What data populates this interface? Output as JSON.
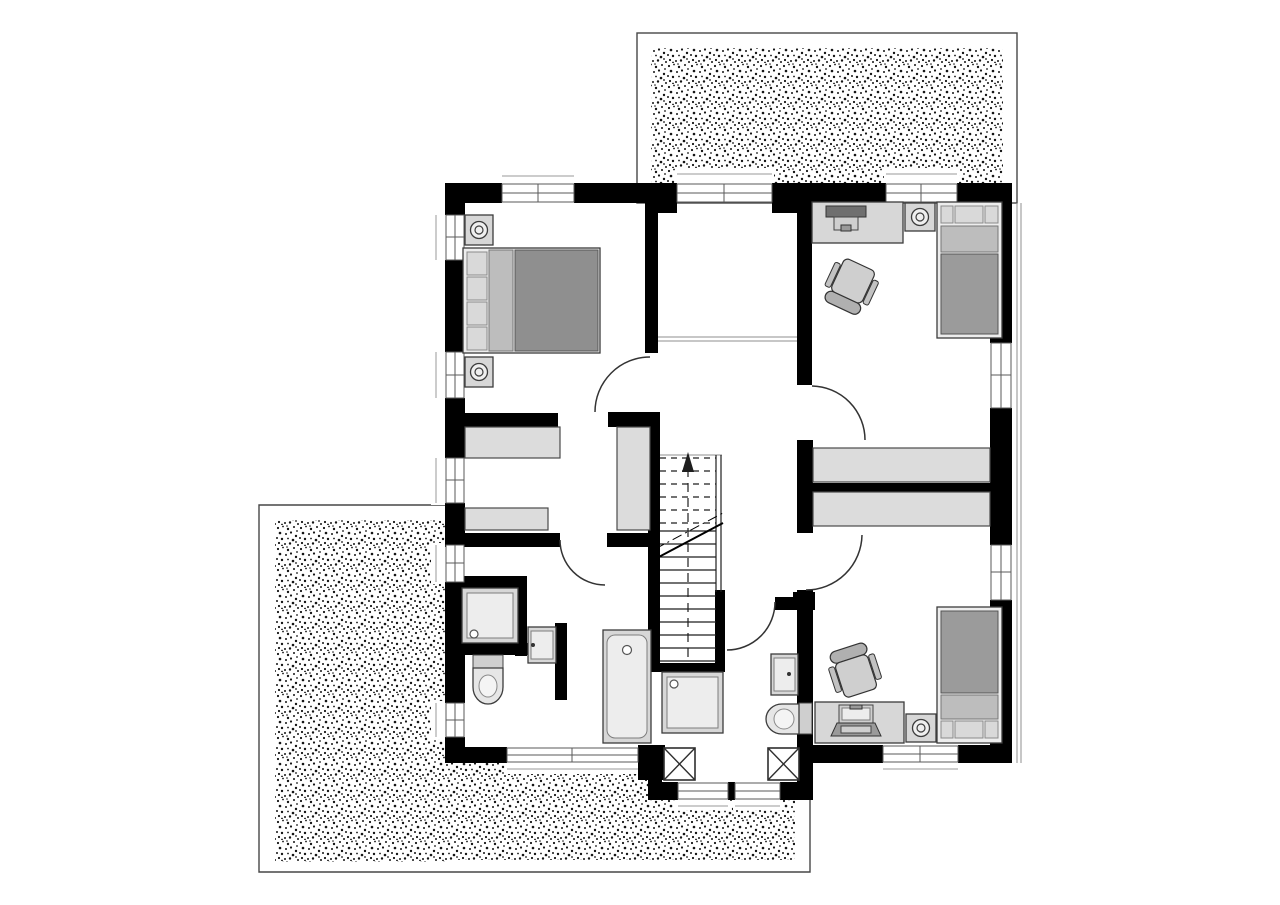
{
  "meta": {
    "label": "Black-and-white architectural floor plan of an upper storey with two stippled roof terraces",
    "canvas_width": 1280,
    "canvas_height": 905
  },
  "palette": {
    "wall": "#000000",
    "floor": "#ffffff",
    "window_frame": "#5a5a5a",
    "furniture_fill": "#d7d7d7",
    "furniture_outline": "#3c3c3c",
    "wardrobe_fill": "#dcdcdc",
    "bed_blanket": "#9b9b9b",
    "bed_fold": "#bdbdbd",
    "bed_pillow": "#d9d9d9",
    "stipple_dot": "#141414",
    "door_arc": "#333333"
  },
  "rooms": [
    {
      "id": "bedroom",
      "label": "Bedroom (top left) with double bed and two nightstands with lamps"
    },
    {
      "id": "gallery",
      "label": "Gallery / open landing (top middle) with railing line and terrace window"
    },
    {
      "id": "child-room-1",
      "label": "Child's room (top right) with desk, monitor, office chair, nightstand, lamp and single bed"
    },
    {
      "id": "dressing-room",
      "label": "Dressing room (middle left) with three wardrobes"
    },
    {
      "id": "hallway",
      "label": "Hallway / landing with straight staircase going up"
    },
    {
      "id": "bathroom-1",
      "label": "Bathroom (bottom left) with shower, washbasin, toilet and bathtub"
    },
    {
      "id": "bathroom-2",
      "label": "Shower room (bottom middle) with shower, washbasin and toilet"
    },
    {
      "id": "child-room-2",
      "label": "Child's room (bottom right) with desk, laptop, office chair, nightstand, lamp and single bed"
    }
  ],
  "outdoor": [
    {
      "id": "terrace-top",
      "label": "Stippled roof terrace at top right"
    },
    {
      "id": "terrace-bottom",
      "label": "Stippled roof terrace wrapping bottom left corner"
    }
  ],
  "stairs": {
    "direction_arrow": "up",
    "solid_tread_lines": 11,
    "dashed_tread_lines": 6,
    "has_center_guide_line": true,
    "has_diagonal_break_line": true
  },
  "counts": {
    "windows": 14,
    "door_swing_arcs": 5,
    "x_marked_shafts": 2,
    "built_in_wardrobes": 5,
    "beds": 3
  }
}
